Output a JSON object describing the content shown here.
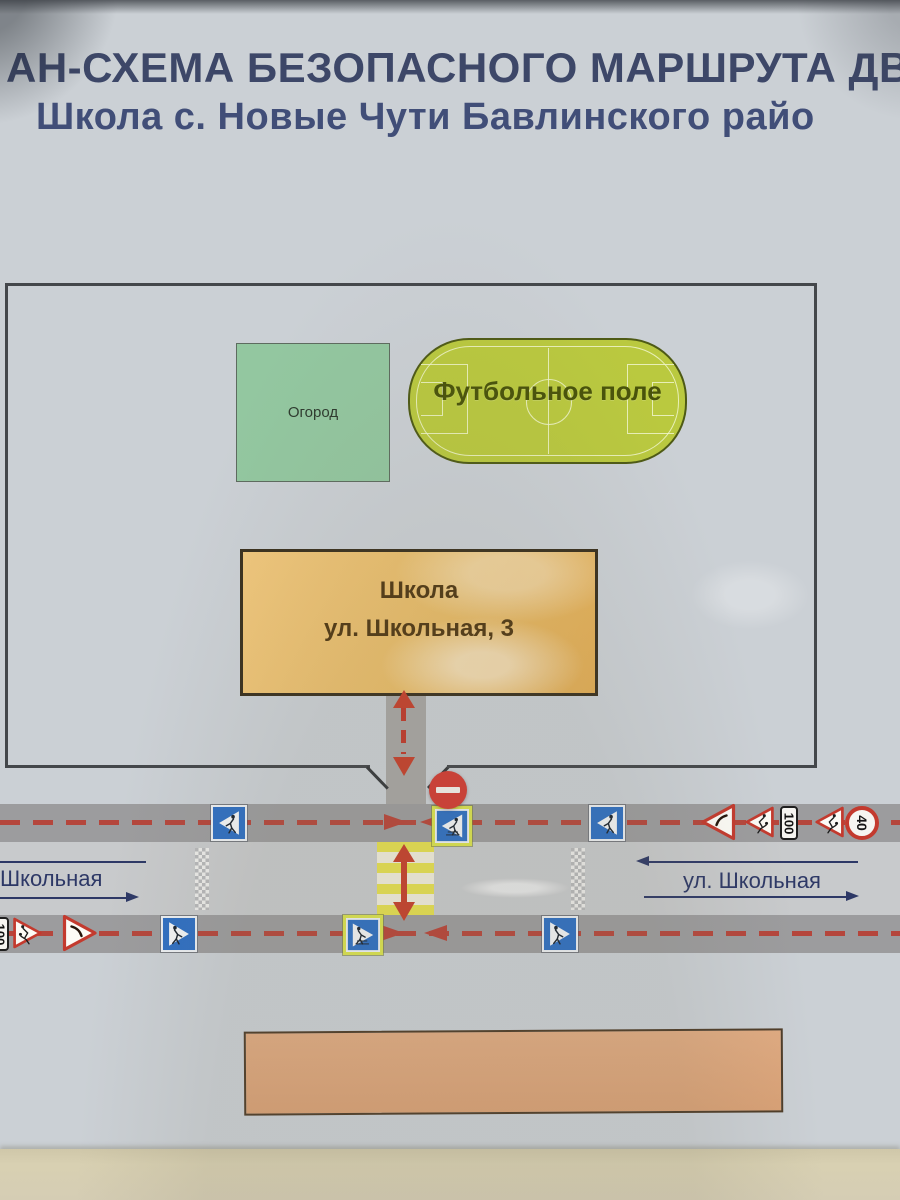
{
  "poster": {
    "title_line1": "АН-СХЕМА БЕЗОПАСНОГО МАРШРУТА ДВ",
    "title_line2": "Школа с. Новые Чути Бавлинского райо"
  },
  "territory": {
    "garden": {
      "label": "Огород",
      "fill": "#93c7a0"
    },
    "football_field": {
      "label": "Футбольное поле",
      "fill": "#bac93f"
    },
    "school": {
      "label_line1": "Школа",
      "label_line2": "ул. Школьная, 3",
      "fill": "#eabd68"
    }
  },
  "streets": {
    "left": {
      "label": "Школьная"
    },
    "right": {
      "label": "ул. Школьная"
    }
  },
  "signs": {
    "distance_plate_label": "100",
    "speed_limit_label": "40"
  },
  "colors": {
    "title_text": "#3d4768",
    "road_gray": "#9c9c9e",
    "route_dash_red": "#b5463c",
    "arrow_red": "#c5402c",
    "sign_blue": "#2e6fc3",
    "sign_yellow_border": "#dbe44f",
    "no_entry_red": "#d33b33",
    "crosswalk_yellow": "#e6e050",
    "bottom_building_tan": "#d9a176",
    "street_text_navy": "#2d3866"
  }
}
